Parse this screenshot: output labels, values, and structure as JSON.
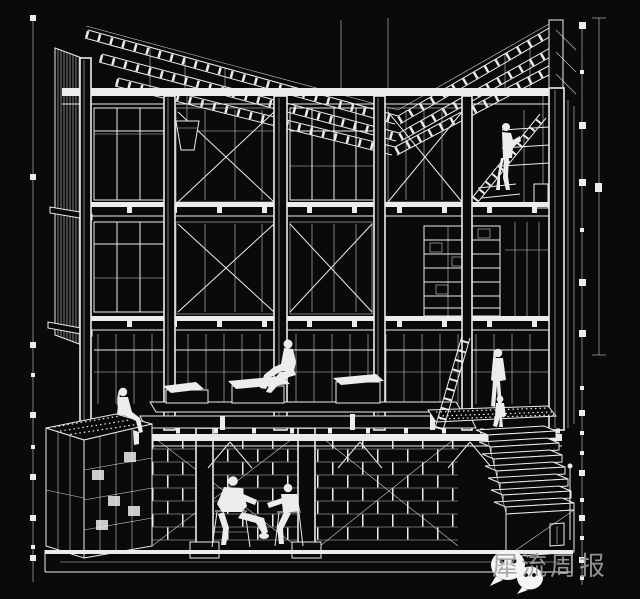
{
  "colors": {
    "background": "#0a0a0a",
    "line": "#ececec",
    "watermark_text": "#9da1a4",
    "icon": "#f5f5f5"
  },
  "watermark": {
    "account_name": "犀流周报",
    "icons": [
      "wechat-bubble-large",
      "wechat-bubble-small"
    ]
  },
  "drawing": {
    "subject": "wireframe architectural section of a multi-storey timber frame building with figures"
  }
}
